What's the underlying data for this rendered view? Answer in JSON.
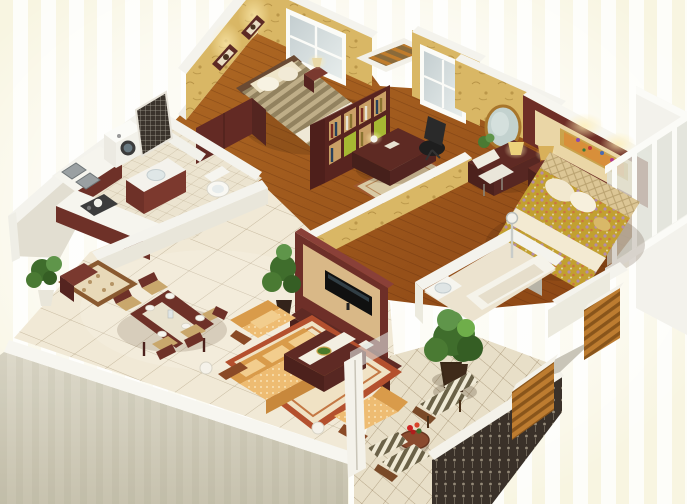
{
  "meta": {
    "kind": "3d-isometric-floor-plan-render",
    "description": "Photorealistic 3D cutaway floor plan of a three-room apartment viewed from above",
    "width_px": 687,
    "height_px": 504
  },
  "palette": {
    "background_white": "#fdfdf9",
    "background_streak": "#f3ecc9",
    "exterior_wall": "#d5d1c1",
    "wall_top_white": "#f7f6f0",
    "wallpaper_gold": "#d9b765",
    "wood_floor": "#a15a1e",
    "tile_cream": "#f1e9d6",
    "balcony_tile": "#e8dfc8",
    "dark_red_wood": "#5f2a24",
    "sofa_gold": "#eebc72",
    "rug_red_border": "#b4502e",
    "master_bed_floral": "#c2a030",
    "second_bed_stripe": "#bfae88",
    "glass": "#dfe2d8",
    "railing_dark": "#3a3129",
    "wood_slats": "#bd7c30",
    "plant_green": "#4a7a33",
    "lamp_glow": "#ffeeb2"
  },
  "scene": {
    "rooms": [
      {
        "id": 0,
        "name": "entry",
        "furniture": [
          "entrance rug",
          "potted plant",
          "shoe cabinet"
        ]
      },
      {
        "id": 1,
        "name": "dining area",
        "furniture": [
          "dining table",
          "five chairs",
          "plates",
          "table runner"
        ]
      },
      {
        "id": 2,
        "name": "living room",
        "furniture": [
          "gold fabric sofa set",
          "coffee table",
          "bordered area rug",
          "tv feature wall",
          "flat screen tv",
          "tv cabinet",
          "potted plant",
          "ball floor lamps"
        ]
      },
      {
        "id": 3,
        "name": "kitchen",
        "furniture": [
          "l-shaped counter",
          "double sink",
          "gas stove",
          "kettle"
        ]
      },
      {
        "id": 4,
        "name": "utility room",
        "furniture": [
          "washing machine",
          "ornate screen"
        ]
      },
      {
        "id": 5,
        "name": "bathroom",
        "furniture": [
          "vanity basin",
          "toilet"
        ]
      },
      {
        "id": 6,
        "name": "second bedroom",
        "furniture": [
          "double bed",
          "striped duvet",
          "two wall pictures",
          "window",
          "wardrobe",
          "nightstand",
          "table lamp"
        ]
      },
      {
        "id": 7,
        "name": "study",
        "furniture": [
          "bookshelf",
          "writing desk",
          "desk lamp",
          "office chair",
          "rug",
          "window"
        ]
      },
      {
        "id": 8,
        "name": "hallway",
        "furniture": [
          "dressing table",
          "round mirror",
          "white chair",
          "table lamp",
          "small plant"
        ]
      },
      {
        "id": 9,
        "name": "master bedroom",
        "furniture": [
          "double bed",
          "floral duvet",
          "tufted headboard",
          "dark red feature wall",
          "framed painting",
          "nightstand",
          "table lamp",
          "tv panel",
          "glass window wall"
        ]
      },
      {
        "id": 10,
        "name": "ensuite bathroom",
        "furniture": [
          "bathtub",
          "shower",
          "washbasin",
          "potted plant"
        ]
      },
      {
        "id": 11,
        "name": "main balcony",
        "furniture": [
          "two striped armchairs",
          "round side table",
          "red flowers",
          "large potted plant",
          "ornate railing",
          "diagonal tiled floor"
        ]
      },
      {
        "id": 12,
        "name": "master balcony",
        "furniture": [
          "glass sliding windows",
          "wooden slat parapet"
        ]
      },
      {
        "id": 13,
        "name": "service balcony",
        "furniture": []
      },
      {
        "id": 14,
        "name": "ac niche",
        "furniture": [
          "wooden slats"
        ]
      }
    ]
  }
}
